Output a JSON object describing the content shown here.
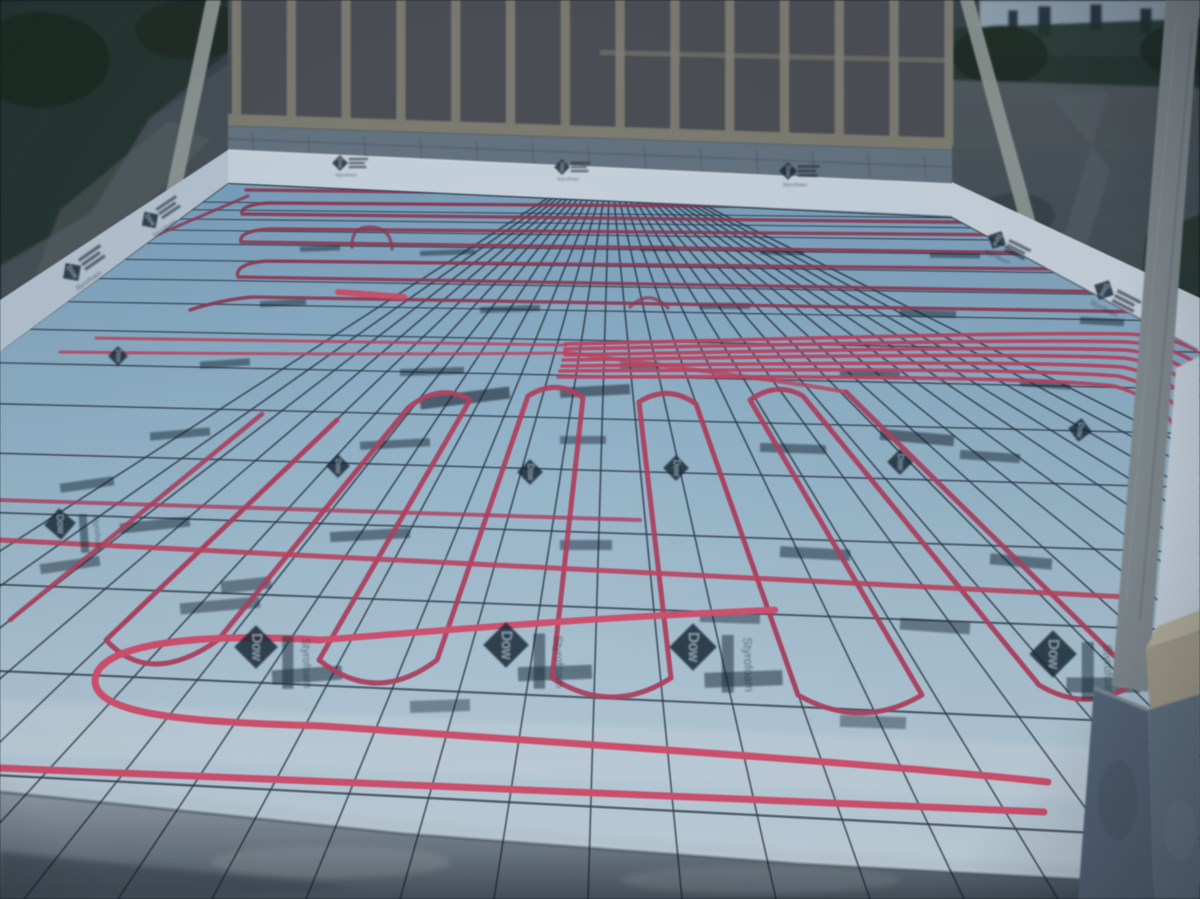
{
  "meta": {
    "title": "Radiant floor heating installation at dusk"
  },
  "scene": {
    "description": "Under-construction slab at dusk: red PEX radiant-heat tubing tied in serpentine loops to steel wire mesh laid over blue foam insulation boards, bordered by white perimeter foam, a concrete-block stem wall and a wood stud-framed wall at the back, dirt and a distant house behind.",
    "time_of_day": "dusk",
    "subjects": [
      "pex-tubing",
      "wire-mesh",
      "foam-insulation-boards",
      "stud-framed-wall",
      "concrete-footing",
      "wood-braces",
      "dirt-yard",
      "distant-house"
    ]
  },
  "brand": {
    "dow": "Dow",
    "styrofoam": "Styrofoam"
  },
  "palette": {
    "vegetation": "#283830",
    "vegetation_dark": "#1d2b22",
    "dirt": "#4b545b",
    "dirt_dark": "#3c4650",
    "house": "#9db0c0",
    "window": "#2c3b46",
    "wall_panel": "#53555a",
    "wall_stud": "#8f8b7c",
    "plate": "#8c8878",
    "block": "#6e7e8c",
    "foam_band": "#dbe7f1",
    "foam_band_side": "#c7d6e4",
    "floor_far": "#8fb8d4",
    "floor_near": "#cfe2ee",
    "ink": "#1c2836",
    "mesh": "#141e2c",
    "pex_far": "#a23a57",
    "pex_mid": "#c74264",
    "pex_bundle": "#d84566",
    "pex_near": "#ee5476",
    "footing": "#8794a0",
    "footing_dark": "#59646f",
    "pier": "#5c6d80",
    "pier_side": "#6b7c8e",
    "wood_post": "#8d9699",
    "wood_block": "#b4ab93",
    "wood_block_top": "#c9c2a9",
    "brace": "#a2aaa4"
  }
}
